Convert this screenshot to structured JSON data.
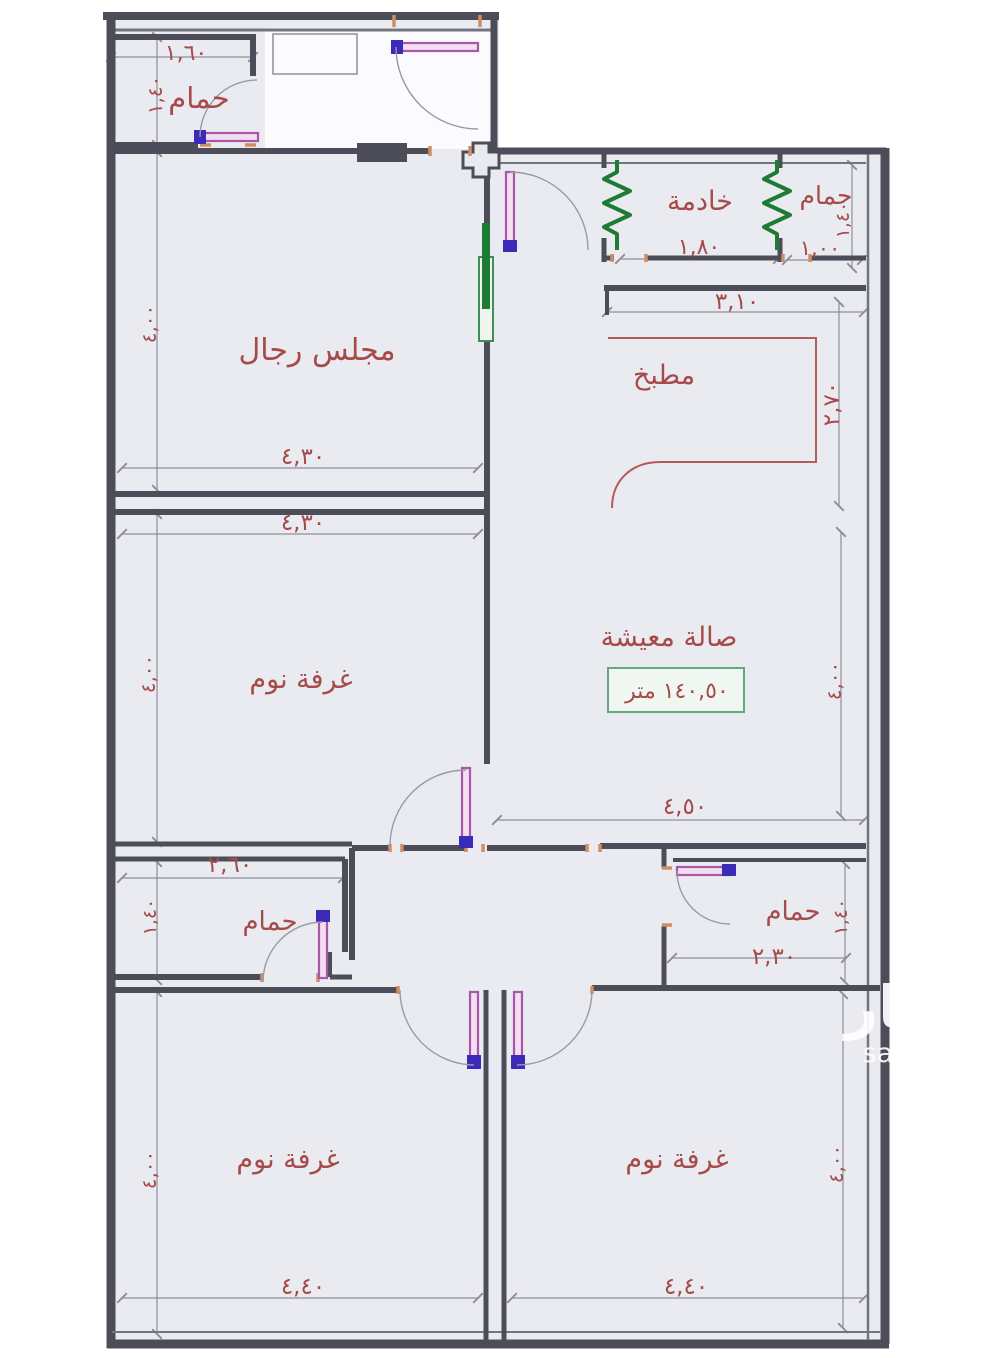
{
  "plan_type": "apartment-floor-plan",
  "rooms": {
    "bathroom_top_left": "حمام",
    "maid_room": "خادمة",
    "bathroom_top_right": "حمام",
    "mens_majlis": "مجلس رجال",
    "kitchen": "مطبخ",
    "living_hall": "صالة معيشة",
    "bedroom_middle_left": "غرفة نوم",
    "bathroom_middle_left": "حمام",
    "bathroom_middle_right": "حمام",
    "bedroom_bottom_left": "غرفة نوم",
    "bedroom_bottom_right": "غرفة نوم"
  },
  "area_box": {
    "text": "١٤٠,٥٠ متر"
  },
  "dimensions": {
    "bath_tl_width": "١,٦٠",
    "bath_tl_height": "١,٤٠",
    "maid_width": "١,٨٠",
    "bath_tr_width": "١,٠٠",
    "bath_tr_height": "١,٤٠",
    "kitchen_width": "٣,١٠",
    "kitchen_height": "٢,٧٠",
    "majlis_width": "٤,٣٠",
    "majlis_height": "٤,٠٠",
    "bedroom_ml_width": "٤,٣٠",
    "bedroom_ml_height": "٤,٠٠",
    "living_width": "٤,٥٠",
    "living_height": "٤,٠٠",
    "bath_ml_width": "٢,٦٠",
    "bath_ml_height": "١,٤٠",
    "bath_mr_width": "٢,٣٠",
    "bath_mr_height": "١,٤٠",
    "bedroom_bl_width": "٤,٤٠",
    "bedroom_bl_height": "٤,٠٠",
    "bedroom_br_width": "٤,٤٠",
    "bedroom_br_height": "٤,٠٠"
  },
  "watermark": {
    "brand": "عقار",
    "site": "sa.aqar"
  },
  "colors": {
    "room_fill": "#eaebf0",
    "wall": "#4c4d58",
    "label_red": "#a64a4a",
    "window_green": "#1e7b33",
    "door_leaf_magenta": "#a757a7",
    "hinge_blue": "#3a2cb8",
    "area_box_green": "#64a87f",
    "counter_red": "#b25c5c",
    "jamb_orange": "#cf8f62"
  }
}
